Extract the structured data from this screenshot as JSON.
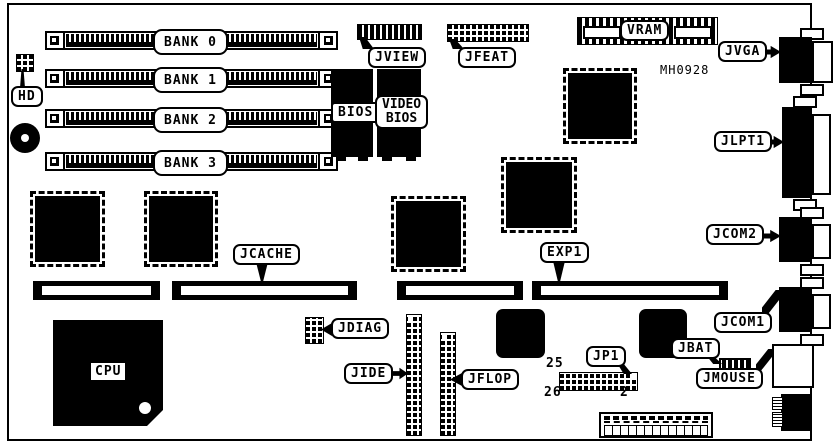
{
  "board": {
    "part_number": "MH0928",
    "memory_banks": [
      {
        "label": "BANK 0"
      },
      {
        "label": "BANK 1"
      },
      {
        "label": "BANK 2"
      },
      {
        "label": "BANK 3"
      }
    ],
    "chips": {
      "cpu": "CPU",
      "bios": "BIOS",
      "video_bios_line1": "VIDEO",
      "video_bios_line2": "BIOS"
    },
    "connectors": {
      "hd": "HD",
      "jview": "JVIEW",
      "jfeat": "JFEAT",
      "vram": "VRAM",
      "jvga": "JVGA",
      "jlpt1": "JLPT1",
      "jcom2": "JCOM2",
      "jcom1": "JCOM1",
      "jmouse": "JMOUSE",
      "jcache": "JCACHE",
      "exp1": "EXP1",
      "jdiag": "JDIAG",
      "jide": "JIDE",
      "jflop": "JFLOP",
      "jp1": "JP1",
      "jbat": "JBAT"
    },
    "jp1_pin_labels": {
      "pin25": "25",
      "pin26": "26",
      "pin2": "2"
    },
    "colors": {
      "ink": "#000000",
      "background": "#ffffff"
    }
  }
}
